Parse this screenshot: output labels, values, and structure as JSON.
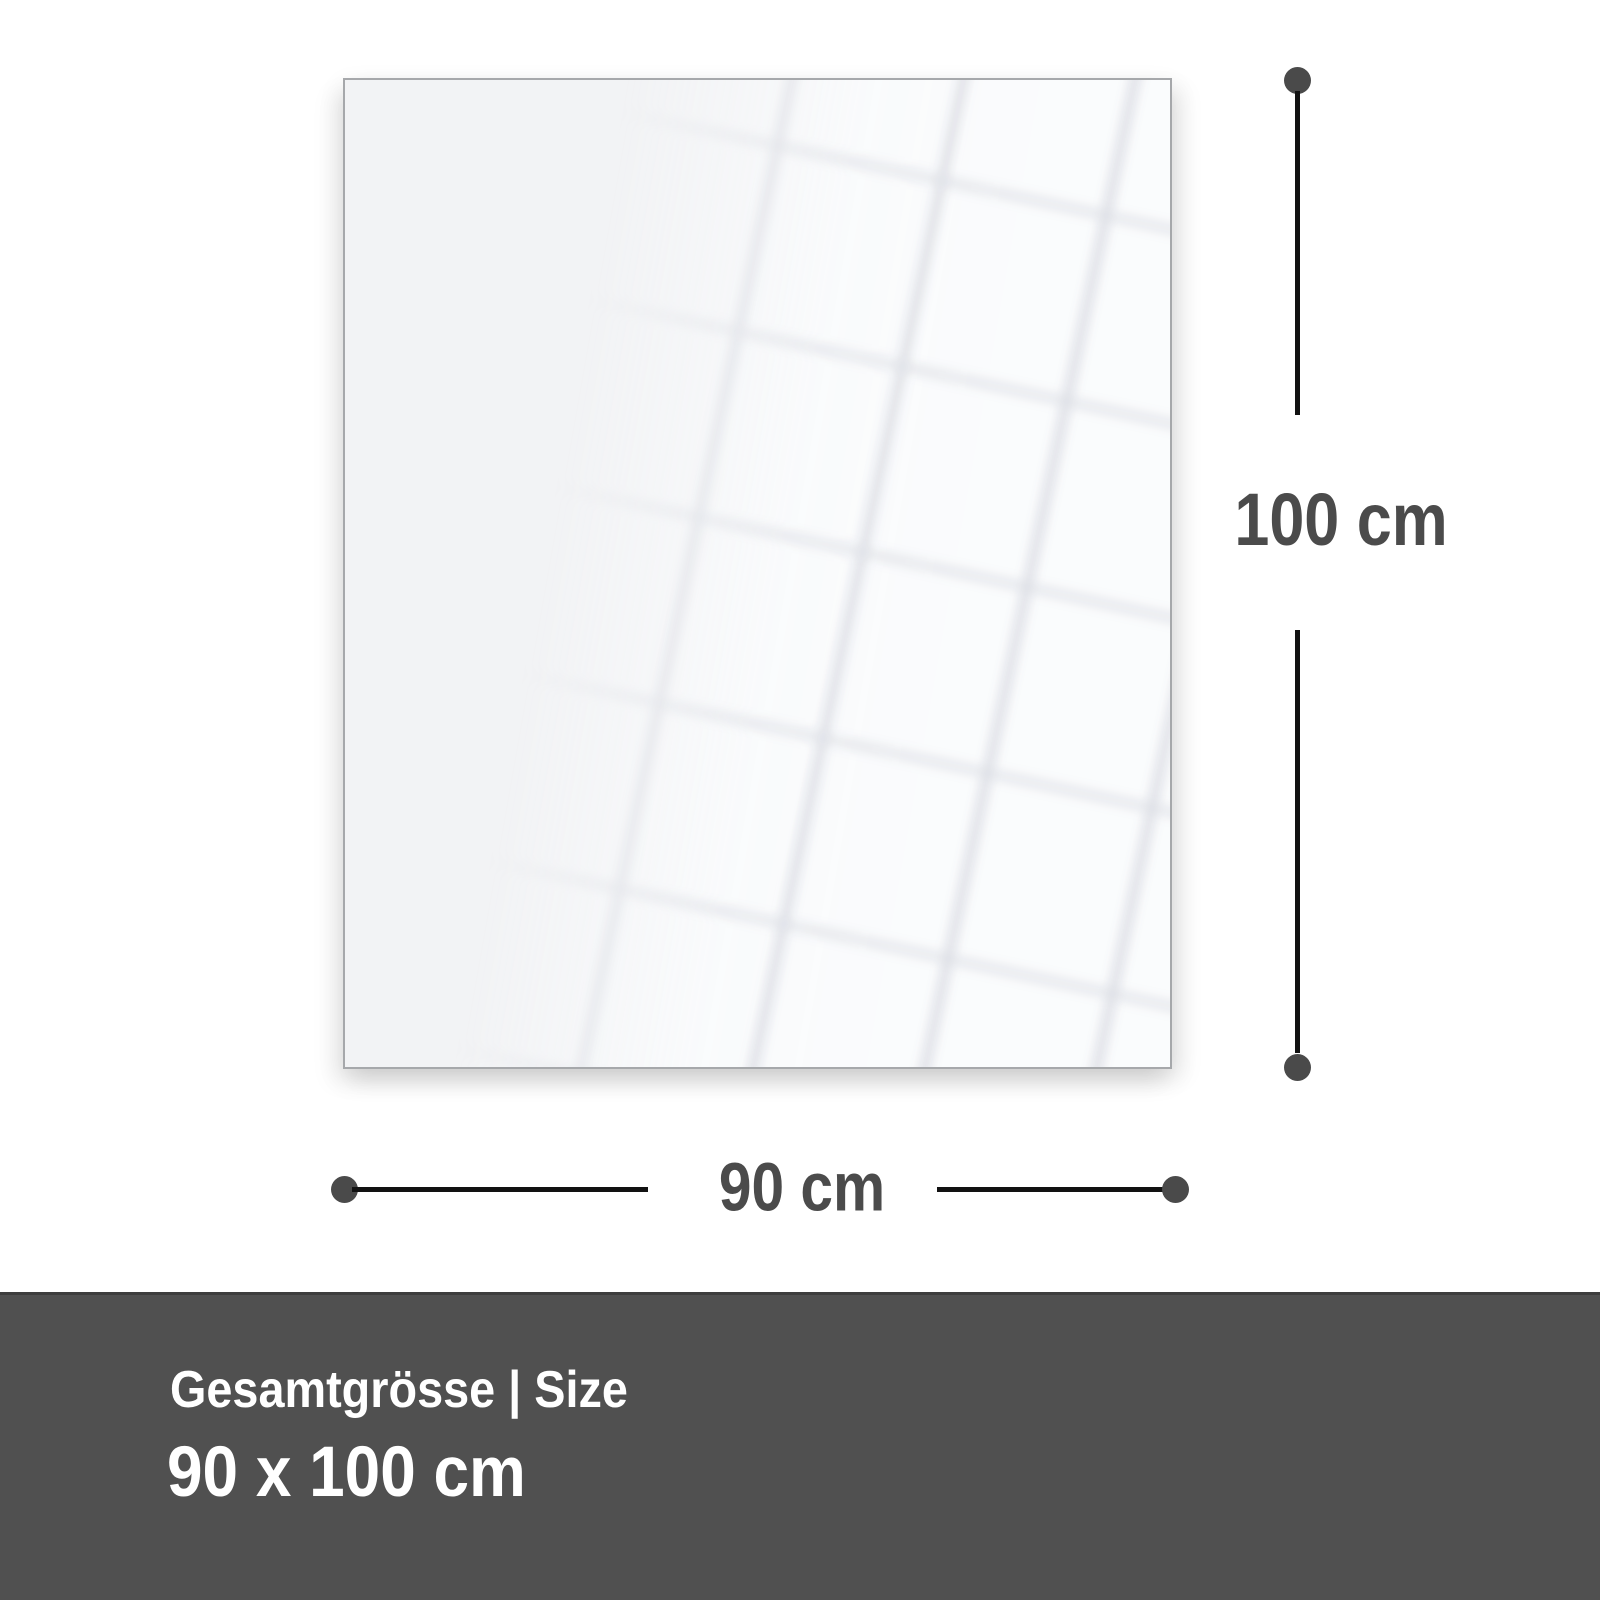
{
  "colors": {
    "page-bg": "#ffffff",
    "panel-fill": "#f2f3f5",
    "panel-border": "#a6a8ab",
    "dim-line": "#121212",
    "dim-dot": "#4a4a4a",
    "dim-text": "#4b4b4b",
    "footer-bg": "#505050",
    "footer-border": "#3d3d3d",
    "footer-text": "#ffffff"
  },
  "dimensions": {
    "height": {
      "label": "100 cm"
    },
    "width": {
      "label": "90 cm"
    }
  },
  "footer": {
    "heading": "Gesamtgrösse | Size",
    "size_value": "90 x 100 cm"
  }
}
